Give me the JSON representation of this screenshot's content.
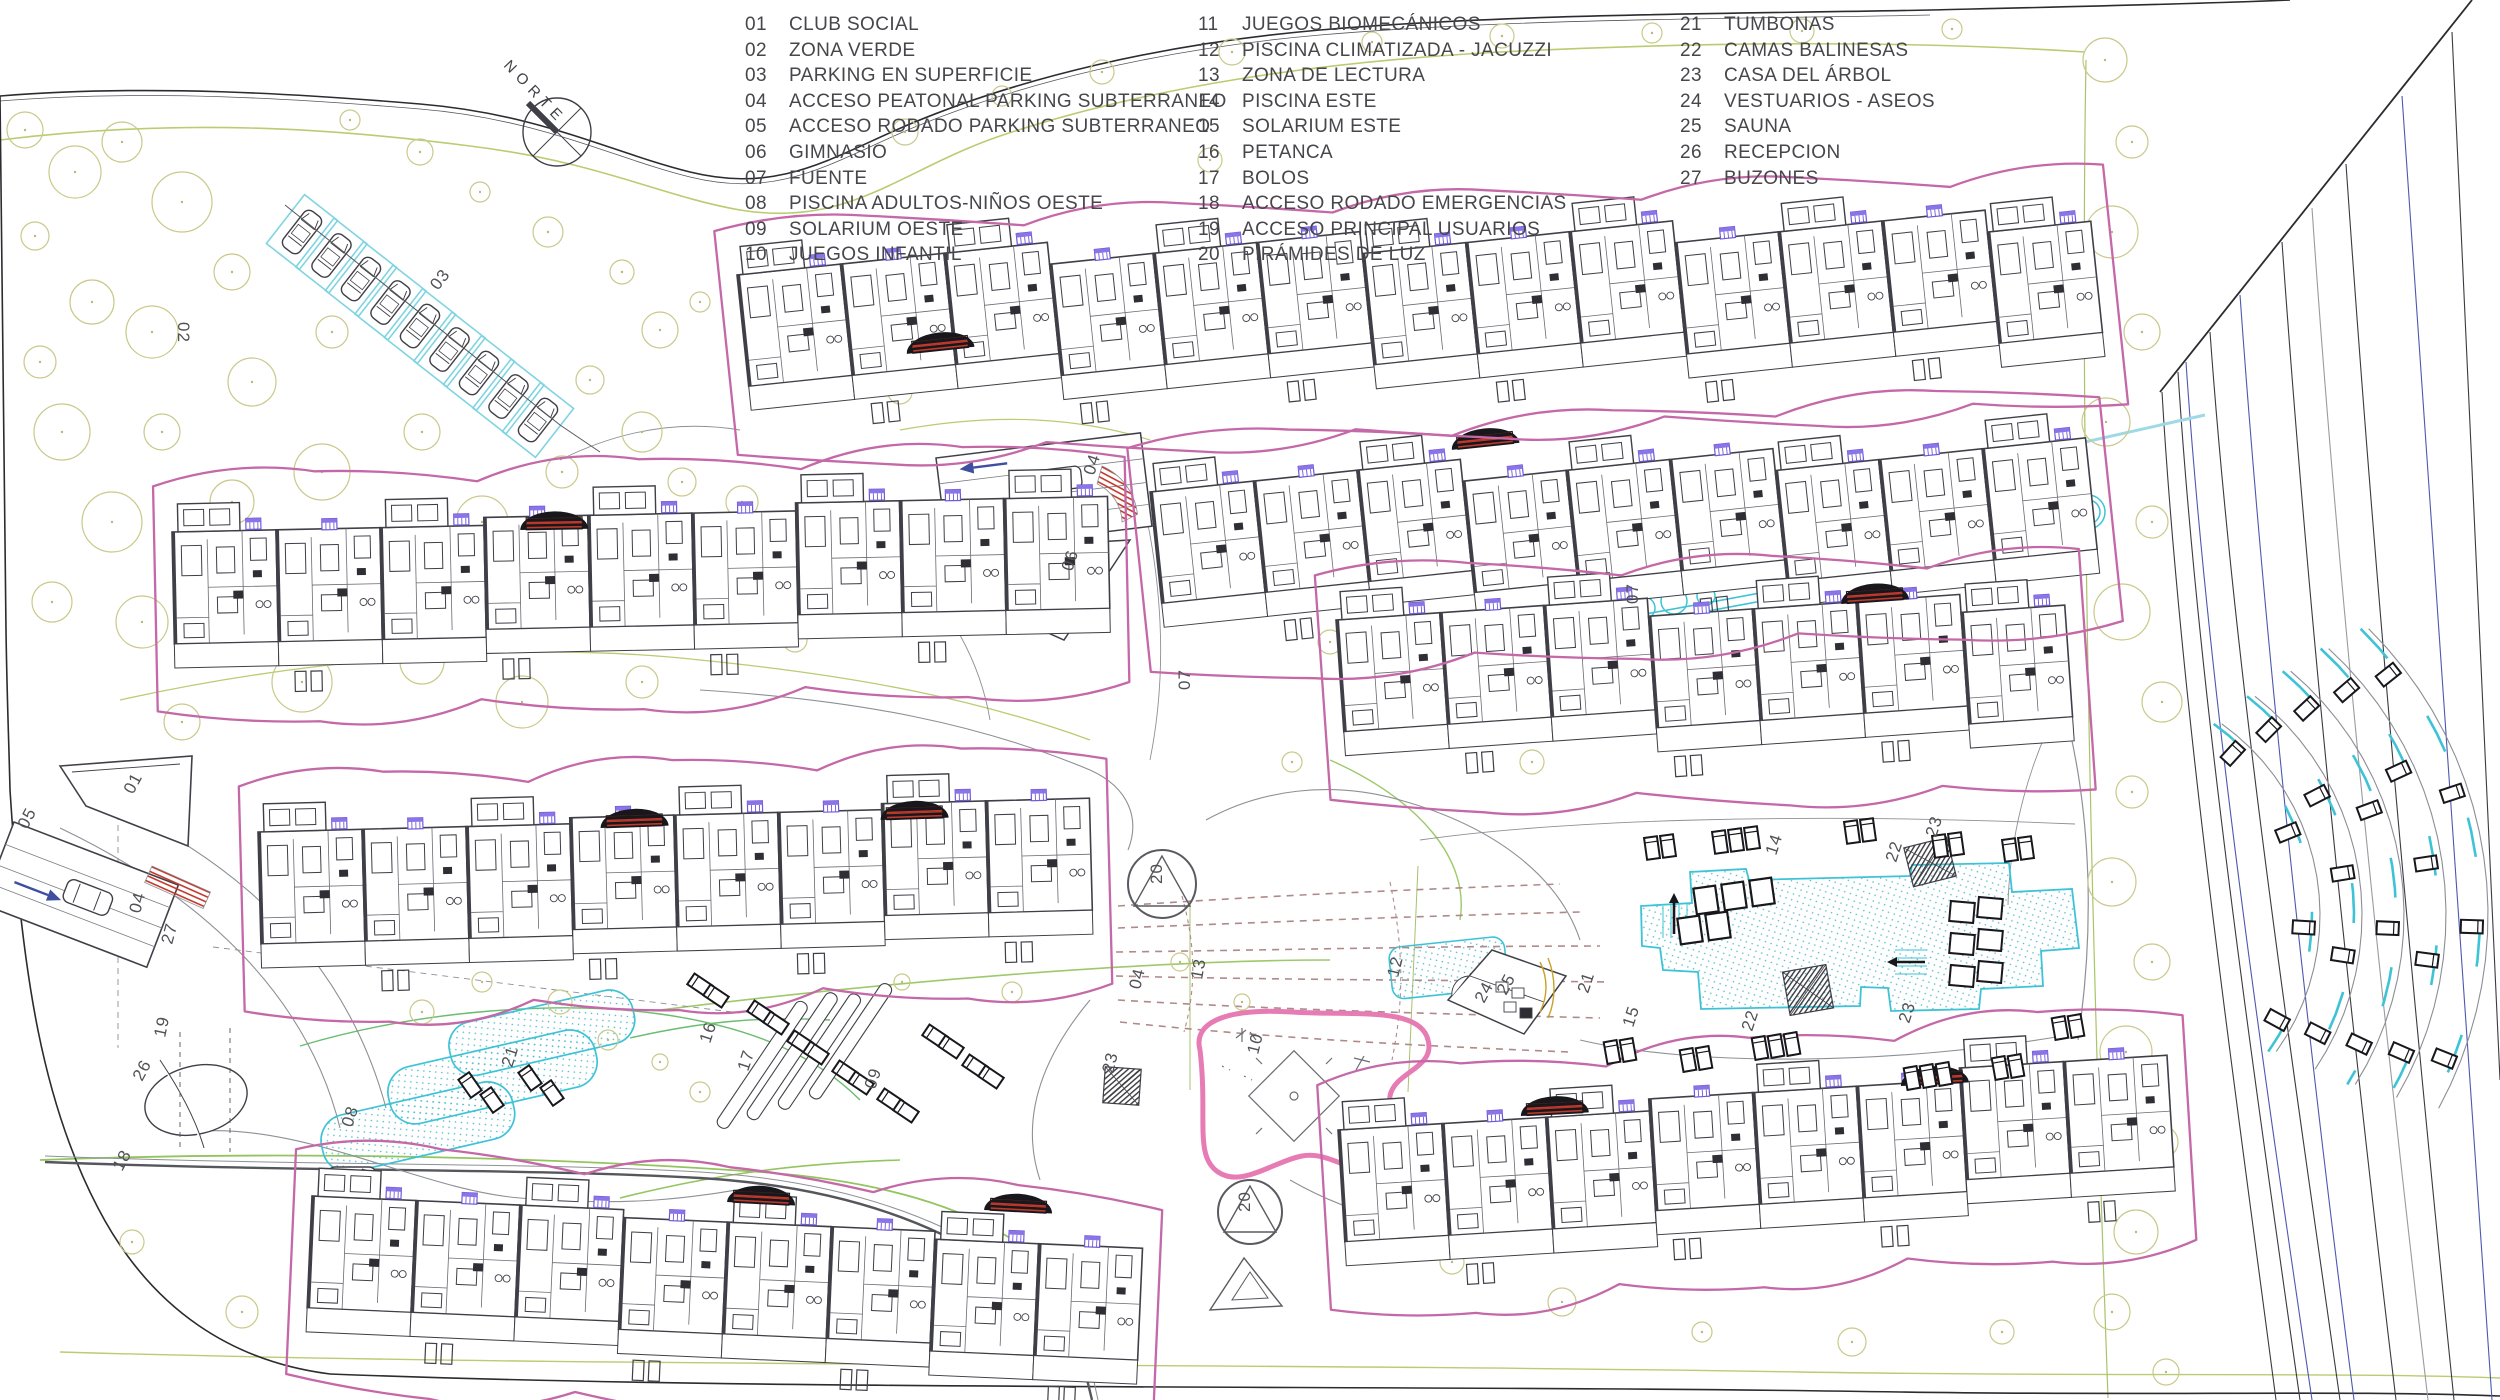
{
  "compass": {
    "label": "NORTE"
  },
  "legend": {
    "columns": [
      [
        {
          "num": "01",
          "label": "CLUB SOCIAL"
        },
        {
          "num": "02",
          "label": "ZONA VERDE"
        },
        {
          "num": "03",
          "label": "PARKING EN SUPERFICIE"
        },
        {
          "num": "04",
          "label": "ACCESO PEATONAL PARKING SUBTERRANEO"
        },
        {
          "num": "05",
          "label": "ACCESO RODADO PARKING SUBTERRANEO"
        },
        {
          "num": "06",
          "label": "GIMNASIO"
        },
        {
          "num": "07",
          "label": "FUENTE"
        },
        {
          "num": "08",
          "label": "PISCINA ADULTOS-NIÑOS OESTE"
        },
        {
          "num": "09",
          "label": "SOLARIUM OESTE"
        },
        {
          "num": "10",
          "label": "JUEGOS INFANTIL"
        }
      ],
      [
        {
          "num": "11",
          "label": "JUEGOS BIOMECÁNICOS"
        },
        {
          "num": "12",
          "label": "PISCINA CLIMATIZADA - JACUZZI"
        },
        {
          "num": "13",
          "label": "ZONA DE LECTURA"
        },
        {
          "num": "14",
          "label": "PISCINA ESTE"
        },
        {
          "num": "15",
          "label": "SOLARIUM ESTE"
        },
        {
          "num": "16",
          "label": "PETANCA"
        },
        {
          "num": "17",
          "label": "BOLOS"
        },
        {
          "num": "18",
          "label": "ACCESO RODADO EMERGENCIAS"
        },
        {
          "num": "19",
          "label": "ACCESO PRINCIPAL USUARIOS"
        },
        {
          "num": "20",
          "label": "PIRÁMIDES DE LUZ"
        }
      ],
      [
        {
          "num": "21",
          "label": "TUMBONAS"
        },
        {
          "num": "22",
          "label": "CAMAS BALINESAS"
        },
        {
          "num": "23",
          "label": "CASA DEL ÁRBOL"
        },
        {
          "num": "24",
          "label": "VESTUARIOS - ASEOS"
        },
        {
          "num": "25",
          "label": "SAUNA"
        },
        {
          "num": "26",
          "label": "RECEPCION"
        },
        {
          "num": "27",
          "label": "BUZONES"
        }
      ]
    ]
  },
  "plan": {
    "markers": [
      {
        "n": "02",
        "x": 178,
        "y": 322,
        "r": 90
      },
      {
        "n": "03",
        "x": 438,
        "y": 291,
        "r": -52
      },
      {
        "n": "01",
        "x": 133,
        "y": 795,
        "r": -62
      },
      {
        "n": "05",
        "x": 27,
        "y": 830,
        "r": -62
      },
      {
        "n": "04",
        "x": 140,
        "y": 914,
        "r": -75
      },
      {
        "n": "27",
        "x": 172,
        "y": 945,
        "r": -75
      },
      {
        "n": "19",
        "x": 165,
        "y": 1038,
        "r": -78
      },
      {
        "n": "26",
        "x": 142,
        "y": 1082,
        "r": -62
      },
      {
        "n": "18",
        "x": 122,
        "y": 1172,
        "r": -62
      },
      {
        "n": "08",
        "x": 352,
        "y": 1128,
        "r": -72
      },
      {
        "n": "21",
        "x": 512,
        "y": 1068,
        "r": -72
      },
      {
        "n": "16",
        "x": 710,
        "y": 1044,
        "r": -72
      },
      {
        "n": "17",
        "x": 748,
        "y": 1072,
        "r": -72
      },
      {
        "n": "09",
        "x": 875,
        "y": 1090,
        "r": -72
      },
      {
        "n": "04",
        "x": 1094,
        "y": 476,
        "r": -72
      },
      {
        "n": "06",
        "x": 1072,
        "y": 572,
        "r": -72
      },
      {
        "n": "07",
        "x": 1190,
        "y": 690,
        "r": -90
      },
      {
        "n": "07",
        "x": 1638,
        "y": 604,
        "r": -90
      },
      {
        "n": "20",
        "x": 1162,
        "y": 884,
        "r": -90
      },
      {
        "n": "13",
        "x": 1202,
        "y": 980,
        "r": -80
      },
      {
        "n": "04",
        "x": 1140,
        "y": 990,
        "r": -76
      },
      {
        "n": "12",
        "x": 1398,
        "y": 978,
        "r": -76
      },
      {
        "n": "10",
        "x": 1258,
        "y": 1055,
        "r": -76
      },
      {
        "n": "23",
        "x": 1113,
        "y": 1074,
        "r": -76
      },
      {
        "n": "20",
        "x": 1250,
        "y": 1212,
        "r": -90
      },
      {
        "n": "24",
        "x": 1484,
        "y": 1004,
        "r": -62
      },
      {
        "n": "25",
        "x": 1506,
        "y": 996,
        "r": -62
      },
      {
        "n": "21",
        "x": 1588,
        "y": 994,
        "r": -72
      },
      {
        "n": "15",
        "x": 1633,
        "y": 1028,
        "r": -72
      },
      {
        "n": "22",
        "x": 1752,
        "y": 1032,
        "r": -72
      },
      {
        "n": "23",
        "x": 1909,
        "y": 1024,
        "r": -72
      },
      {
        "n": "14",
        "x": 1776,
        "y": 856,
        "r": -72
      },
      {
        "n": "22",
        "x": 1896,
        "y": 863,
        "r": -72
      },
      {
        "n": "23",
        "x": 1936,
        "y": 838,
        "r": -72
      }
    ]
  },
  "colors": {
    "building_line": "#3f3f47",
    "boundary": "#2b2b30",
    "magenta": "#c468a8",
    "pink_playground": "#e77bb4",
    "cyan_water": "#3ec3d6",
    "green_landscape": "#b9cc71",
    "bright_green": "#69bd6d",
    "tree_olive": "#c9c98a",
    "road_navy": "#4d58ae",
    "stair_red": "#c0392b",
    "glyph_purple": "#7059d8",
    "label_gray": "#515156"
  }
}
